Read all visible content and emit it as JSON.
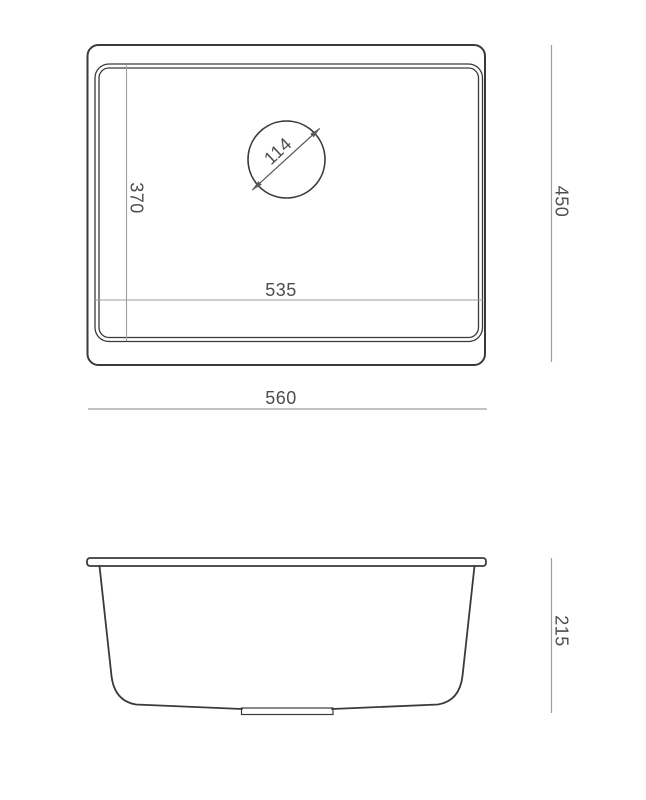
{
  "colors": {
    "background": "#ffffff",
    "outline": "#3a3a3a",
    "dimension_line": "#9e9e9e",
    "drain_dimension": "#5a5a5a",
    "text": "#4d4d4d"
  },
  "top_view": {
    "dimensions": {
      "drain_diameter": "114",
      "inner_width": "370",
      "inner_length": "535",
      "overall_width": "450",
      "overall_length": "560"
    }
  },
  "side_view": {
    "dimensions": {
      "height": "215"
    }
  }
}
